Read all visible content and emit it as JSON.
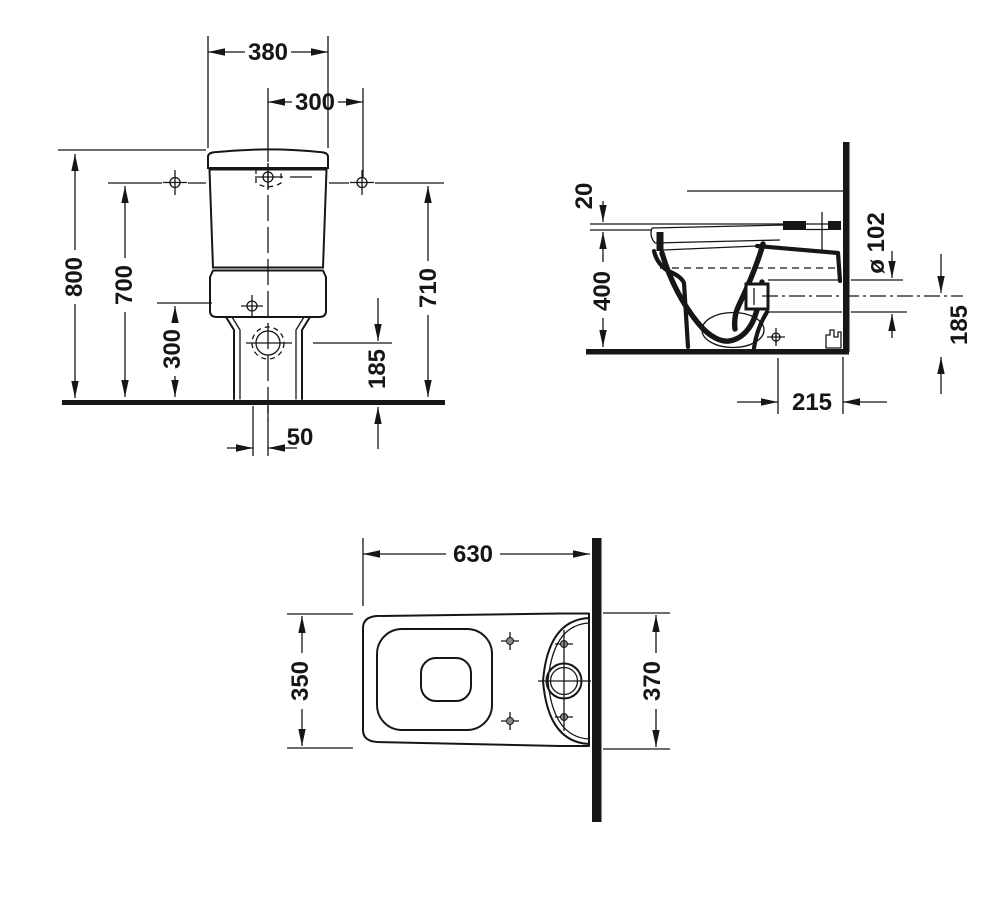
{
  "drawing": {
    "kind": "sanitary technical drawing - close-coupled toilet",
    "colors": {
      "ink": "#161616",
      "paper": "#ffffff"
    },
    "front_view": {
      "dims": {
        "cistern_width": "380",
        "center_to_connection": "300",
        "overall_height": "800",
        "connection_height": "700",
        "supply_inlet_height": "300",
        "cistern_top_height": "710",
        "outlet_center_height": "185",
        "outlet_center_offset": "50"
      }
    },
    "side_view": {
      "dims": {
        "seat_clearance": "20",
        "bowl_rim_height": "400",
        "outlet_diameter": "ø 102",
        "outlet_axis_height": "185",
        "outlet_to_wall": "215"
      }
    },
    "top_view": {
      "dims": {
        "overall_depth": "630",
        "bowl_width": "350",
        "cistern_width": "370"
      }
    }
  }
}
